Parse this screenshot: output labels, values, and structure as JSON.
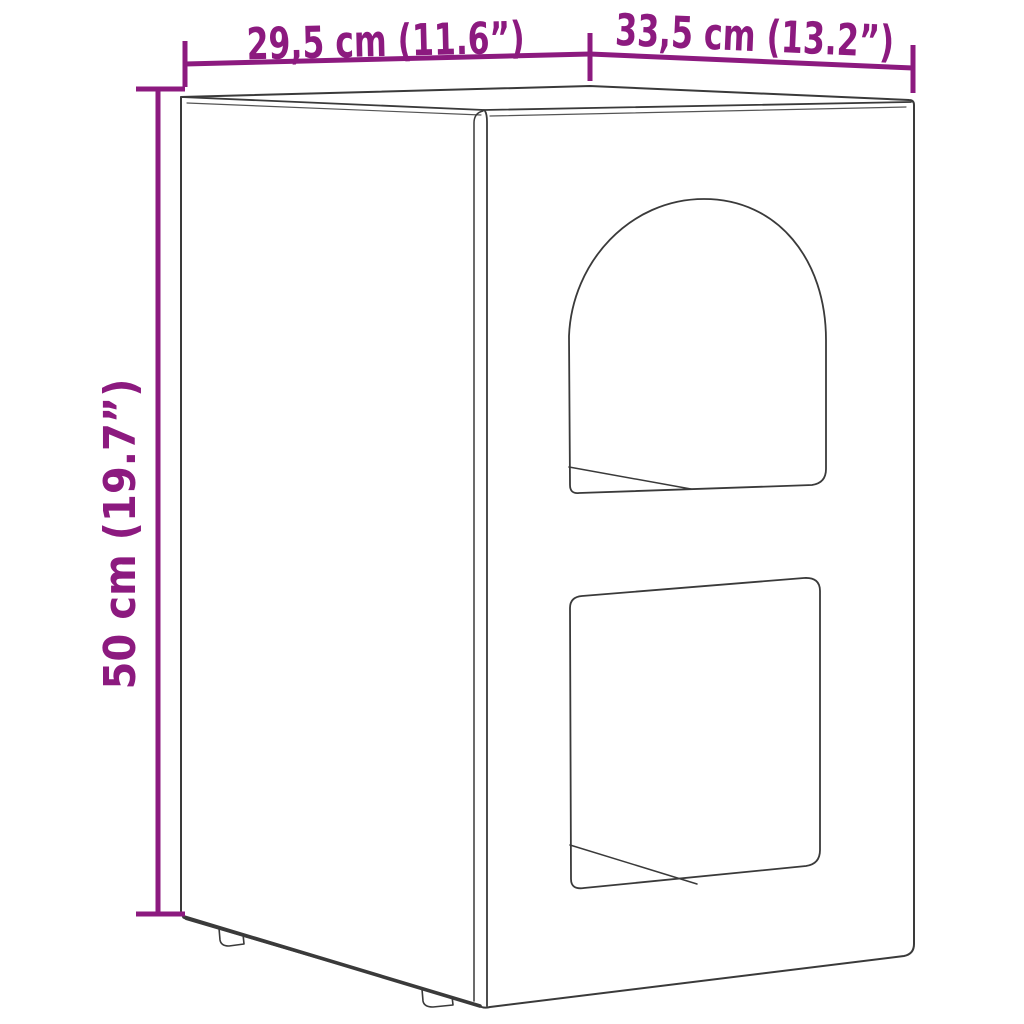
{
  "figure": {
    "kind": "product-dimension-diagram",
    "alt": "Wireframe line drawing of a rectangular box-shaped side table / pet house with an arched opening on top and a rounded square opening below, shown in perspective with two small feet visible",
    "dimensions": {
      "top_left_label": "29,5 cm (11.6”)",
      "top_right_label": "33,5 cm (13.2”)",
      "left_label": "50 cm (19.7”)"
    },
    "colors": {
      "dimension": "#8C1A7F",
      "line_art": "#3a3a3a",
      "line_art_soft": "#555555",
      "background": "#ffffff"
    }
  }
}
